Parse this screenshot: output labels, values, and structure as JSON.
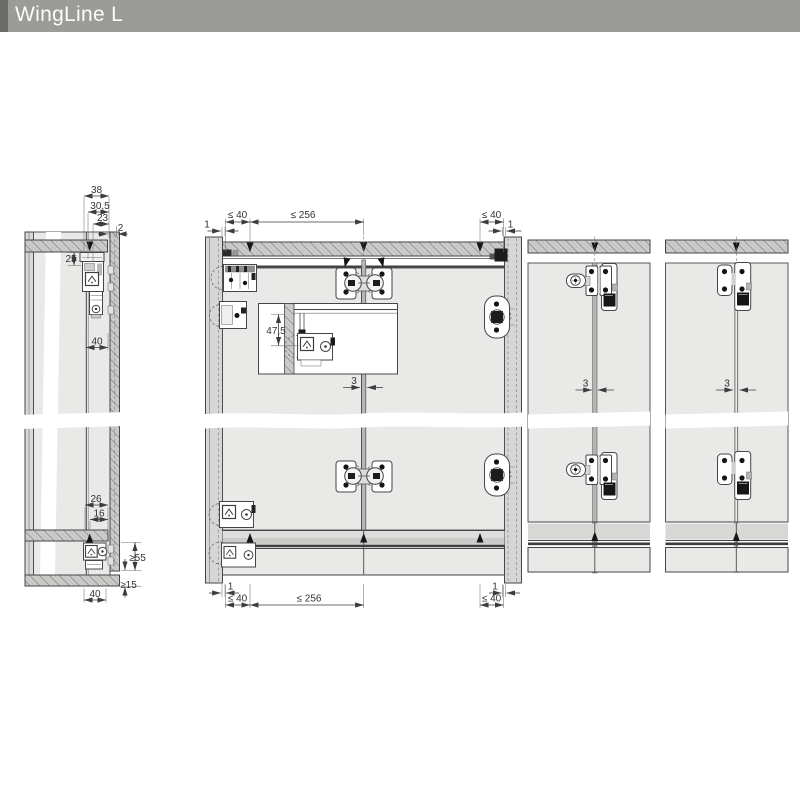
{
  "header": {
    "title": "WingLine L"
  },
  "colors": {
    "header_bg": "#9b9b97",
    "header_accent": "#6c6c66",
    "header_text": "#fbfbfa",
    "panel_face": "#e9e9e7",
    "panel_section": "#c9c9c7",
    "outline": "#46464a",
    "hardware_black": "#161616"
  },
  "side_view": {
    "dims": {
      "depth_total": "38",
      "depth_305": "30,5",
      "depth_23": "23",
      "gap_2": "2",
      "height_25": "25",
      "width_40_top": "40",
      "depth_26": "26",
      "depth_16": "16",
      "min_55": "≥55",
      "min_15": "≥15",
      "width_40_bottom": "40"
    }
  },
  "front_view": {
    "dims_top": {
      "edge_1_left": "1",
      "first_40_left": "≤ 40",
      "spacing_256": "≤ 256",
      "first_40_right": "≤ 40",
      "edge_1_right": "1"
    },
    "dims_bottom": {
      "edge_1_left": "1",
      "first_40_left": "≤ 40",
      "spacing_256": "≤ 256",
      "first_40_right": "≤ 40",
      "edge_1_right": "1"
    },
    "detail": {
      "height_475": "47,5"
    },
    "gap_3": "3"
  },
  "variant_a": {
    "gap_3": "3"
  },
  "variant_b": {
    "gap_3": "3"
  }
}
